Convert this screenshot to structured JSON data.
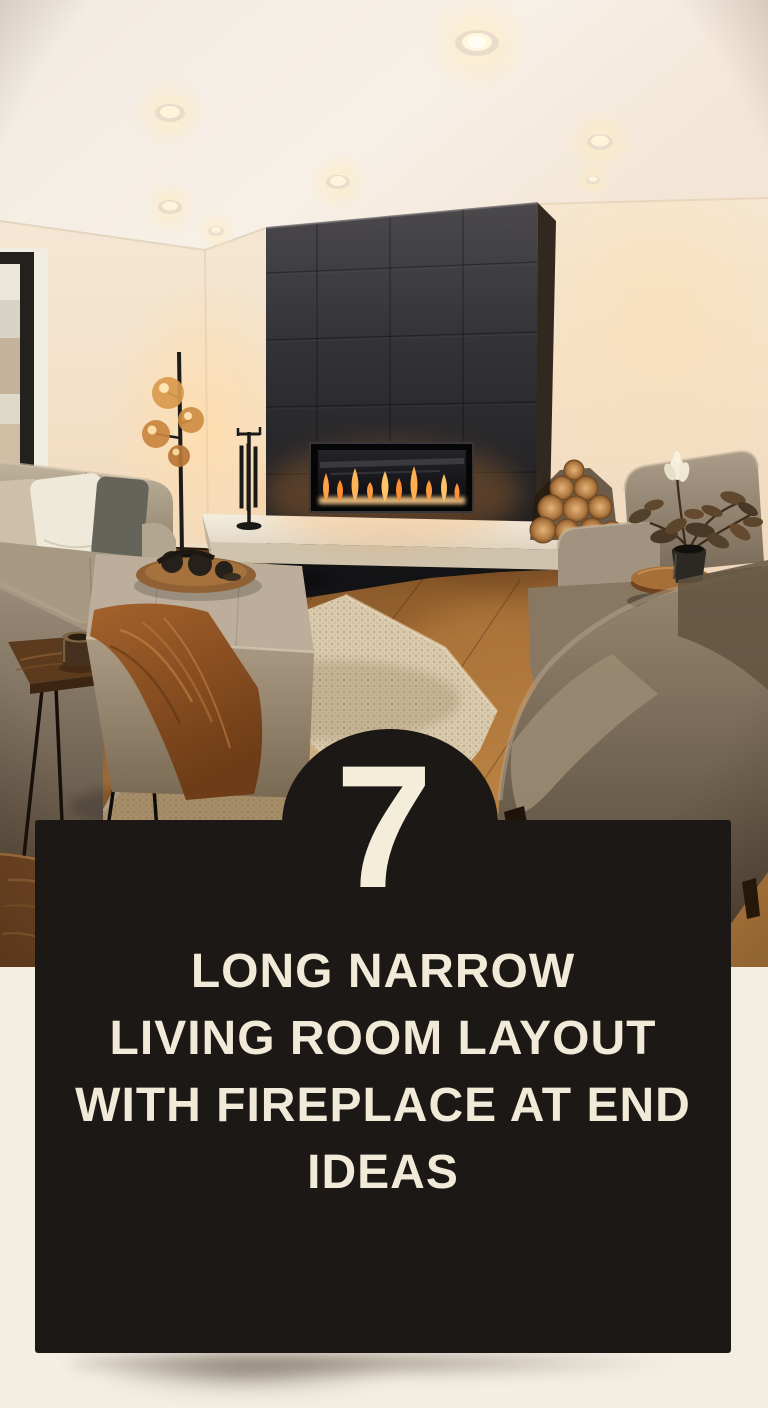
{
  "pin": {
    "background_color": "#f3ede2",
    "card": {
      "background_color": "#1c1815",
      "text_color": "#f1ead8",
      "number": "7",
      "title_lines": [
        "LONG NARROW",
        "LIVING ROOM LAYOUT",
        "WITH FIREPLACE AT END",
        "IDEAS"
      ]
    },
    "photo": {
      "label": "Long narrow living room with linear fireplace at end wall",
      "colors": {
        "wall": "#f3dfc5",
        "ceiling": "#f5eee6",
        "fireplace_wall": "#2c2b2e",
        "flame": "#ff9a38",
        "hearth_bench": "#eee6d6",
        "wood_floor": "#a06a33",
        "rug": "#d8c9af",
        "upholstery": "#9a8c77"
      }
    }
  }
}
